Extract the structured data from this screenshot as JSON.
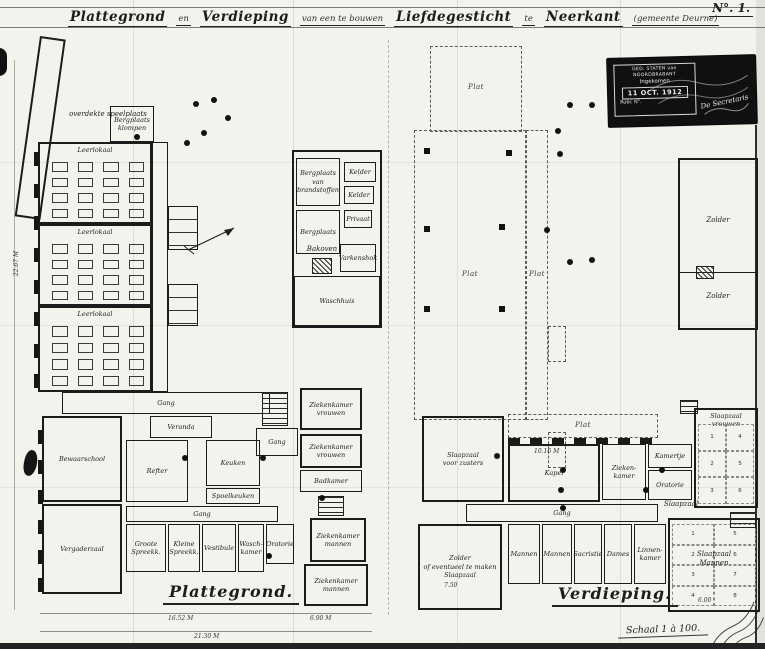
{
  "sheet": {
    "title_segments": [
      {
        "text": "Plattegrond"
      },
      {
        "text": "en"
      },
      {
        "text": "Verdieping"
      },
      {
        "text": "van een te bouwen"
      },
      {
        "text": "Liefdegesticht"
      },
      {
        "text": "te"
      },
      {
        "text": "Neerkant"
      },
      {
        "text": "(gemeente Deurne)"
      }
    ],
    "sheet_no": "N°. 1.",
    "stamp": {
      "agency": "GED. STATEN van NOORDBRABANT",
      "line_received": "Ingekomen",
      "date": "11 OCT. 1912",
      "rubric_label": "Rubr.        N°.",
      "secretary": "De Secretaris"
    },
    "scale_note": "Schaal 1 à 100.",
    "colors": {
      "paper": "#f3f2ec",
      "ink": "#1c1c1c",
      "stamp_bg": "#101010"
    }
  },
  "plan_left": {
    "caption": "Plattegrond.",
    "items": [
      {
        "type": "room",
        "name": "wing-overdekte-speelplaats",
        "label": "",
        "x": 40,
        "y": 36,
        "w": 26,
        "h": 182,
        "rot": 8,
        "thick": true
      },
      {
        "type": "text",
        "label": "overdekte speelplaats",
        "x": 56,
        "y": 110,
        "w": 104,
        "h": 12
      },
      {
        "type": "room",
        "label": "Bergplaats\nklompen",
        "x": 110,
        "y": 106,
        "w": 44,
        "h": 36
      },
      {
        "type": "room",
        "label": "Leerlokaal",
        "x": 38,
        "y": 142,
        "w": 114,
        "h": 82,
        "labelPos": "top",
        "thick": true
      },
      {
        "type": "desks",
        "x": 52,
        "y": 162,
        "w": 92,
        "h": 56,
        "cols": 4,
        "rows": 4
      },
      {
        "type": "room",
        "label": "Leerlokaal",
        "x": 38,
        "y": 224,
        "w": 114,
        "h": 82,
        "labelPos": "top",
        "thick": true
      },
      {
        "type": "desks",
        "x": 52,
        "y": 244,
        "w": 92,
        "h": 56,
        "cols": 4,
        "rows": 4
      },
      {
        "type": "room",
        "label": "Leerlokaal",
        "x": 38,
        "y": 306,
        "w": 114,
        "h": 86,
        "labelPos": "top",
        "thick": true
      },
      {
        "type": "desks",
        "x": 52,
        "y": 326,
        "w": 92,
        "h": 60,
        "cols": 4,
        "rows": 4
      },
      {
        "type": "room",
        "name": "gang-leerlokalen",
        "label": "",
        "x": 152,
        "y": 142,
        "w": 16,
        "h": 250
      },
      {
        "type": "privaat",
        "name": "privaten-a",
        "x": 168,
        "y": 206,
        "w": 30,
        "h": 44
      },
      {
        "type": "privaat",
        "name": "privaten-b",
        "x": 168,
        "y": 284,
        "w": 30,
        "h": 42
      },
      {
        "type": "room",
        "name": "utility-wing",
        "label": "",
        "x": 292,
        "y": 150,
        "w": 90,
        "h": 178,
        "thick": true
      },
      {
        "type": "room",
        "label": "Bergplaats\nvan\nbrandstoffen",
        "x": 296,
        "y": 158,
        "w": 44,
        "h": 48
      },
      {
        "type": "room",
        "label": "Kelder",
        "x": 344,
        "y": 162,
        "w": 32,
        "h": 20
      },
      {
        "type": "room",
        "label": "Kelder",
        "x": 344,
        "y": 186,
        "w": 30,
        "h": 18
      },
      {
        "type": "room",
        "label": "Bergplaats",
        "x": 296,
        "y": 210,
        "w": 44,
        "h": 44
      },
      {
        "type": "room",
        "label": "Privaat",
        "x": 344,
        "y": 210,
        "w": 28,
        "h": 18
      },
      {
        "type": "hatchbox",
        "name": "bakoven-hatch",
        "x": 312,
        "y": 258,
        "w": 20,
        "h": 16
      },
      {
        "type": "text",
        "label": "Bakoven",
        "x": 304,
        "y": 245,
        "w": 36,
        "h": 10
      },
      {
        "type": "room",
        "label": "Varkenshok",
        "x": 340,
        "y": 244,
        "w": 36,
        "h": 28
      },
      {
        "type": "room",
        "label": "Waschhuis",
        "x": 294,
        "y": 276,
        "w": 86,
        "h": 50
      },
      {
        "type": "room",
        "label": "Gang",
        "x": 62,
        "y": 392,
        "w": 208,
        "h": 22
      },
      {
        "type": "room",
        "label": "Veranda",
        "x": 150,
        "y": 416,
        "w": 62,
        "h": 22
      },
      {
        "type": "room",
        "label": "Bewaarschool",
        "x": 42,
        "y": 416,
        "w": 80,
        "h": 86,
        "thick": true
      },
      {
        "type": "room",
        "label": "Refter",
        "x": 126,
        "y": 440,
        "w": 62,
        "h": 62
      },
      {
        "type": "room",
        "label": "Keuken",
        "x": 206,
        "y": 440,
        "w": 54,
        "h": 46
      },
      {
        "type": "room",
        "label": "Spoelkeuken",
        "x": 206,
        "y": 488,
        "w": 54,
        "h": 16
      },
      {
        "type": "room",
        "name": "gang-bottom",
        "label": "Gang",
        "x": 126,
        "y": 506,
        "w": 152,
        "h": 16
      },
      {
        "type": "room",
        "label": "Vergaderzaal",
        "x": 42,
        "y": 504,
        "w": 80,
        "h": 90,
        "thick": true
      },
      {
        "type": "room",
        "label": "Groote\nSpreekk.",
        "x": 126,
        "y": 524,
        "w": 40,
        "h": 48
      },
      {
        "type": "room",
        "label": "Kleine\nSpreekk.",
        "x": 168,
        "y": 524,
        "w": 32,
        "h": 48
      },
      {
        "type": "room",
        "label": "Vestibule",
        "x": 202,
        "y": 524,
        "w": 34,
        "h": 48
      },
      {
        "type": "room",
        "label": "Wasch-\nkamer",
        "x": 238,
        "y": 524,
        "w": 26,
        "h": 48
      },
      {
        "type": "room",
        "label": "Oratorie",
        "x": 266,
        "y": 524,
        "w": 28,
        "h": 40
      },
      {
        "type": "stairs",
        "name": "trap-midden",
        "x": 262,
        "y": 392,
        "w": 26,
        "h": 34
      },
      {
        "type": "room",
        "label": "Gang",
        "x": 256,
        "y": 428,
        "w": 42,
        "h": 28
      },
      {
        "type": "room",
        "label": "Ziekenkamer\nvrouwen",
        "x": 300,
        "y": 388,
        "w": 62,
        "h": 42,
        "thick": true
      },
      {
        "type": "room",
        "label": "Ziekenkamer\nvrouwen",
        "x": 300,
        "y": 434,
        "w": 62,
        "h": 34,
        "thick": true
      },
      {
        "type": "room",
        "label": "Badkamer",
        "x": 300,
        "y": 470,
        "w": 62,
        "h": 22
      },
      {
        "type": "stairs",
        "name": "trap-rechts",
        "x": 318,
        "y": 496,
        "w": 26,
        "h": 20
      },
      {
        "type": "room",
        "label": "Ziekenkamer\nmannen",
        "x": 310,
        "y": 518,
        "w": 56,
        "h": 44,
        "thick": true
      },
      {
        "type": "room",
        "label": "Ziekenkamer\nmannen",
        "x": 304,
        "y": 564,
        "w": 64,
        "h": 42,
        "thick": true
      },
      {
        "type": "pier",
        "x": 34,
        "y": 152,
        "w": 5,
        "h": 14
      },
      {
        "type": "pier",
        "x": 34,
        "y": 184,
        "w": 5,
        "h": 14
      },
      {
        "type": "pier",
        "x": 34,
        "y": 216,
        "w": 5,
        "h": 14
      },
      {
        "type": "pier",
        "x": 34,
        "y": 248,
        "w": 5,
        "h": 14
      },
      {
        "type": "pier",
        "x": 34,
        "y": 280,
        "w": 5,
        "h": 14
      },
      {
        "type": "pier",
        "x": 34,
        "y": 312,
        "w": 5,
        "h": 14
      },
      {
        "type": "pier",
        "x": 34,
        "y": 344,
        "w": 5,
        "h": 14
      },
      {
        "type": "pier",
        "x": 34,
        "y": 374,
        "w": 5,
        "h": 14
      },
      {
        "type": "pier",
        "x": 38,
        "y": 430,
        "w": 5,
        "h": 14
      },
      {
        "type": "pier",
        "x": 38,
        "y": 460,
        "w": 5,
        "h": 14
      },
      {
        "type": "pier",
        "x": 38,
        "y": 490,
        "w": 5,
        "h": 14
      },
      {
        "type": "pier",
        "x": 38,
        "y": 520,
        "w": 5,
        "h": 14
      },
      {
        "type": "pier",
        "x": 38,
        "y": 550,
        "w": 5,
        "h": 14
      },
      {
        "type": "pier",
        "x": 38,
        "y": 578,
        "w": 5,
        "h": 14
      }
    ]
  },
  "plan_right": {
    "caption": "Verdieping.",
    "items": [
      {
        "type": "dashed",
        "label": "Plat",
        "x": 430,
        "y": 46,
        "w": 92,
        "h": 86,
        "labelPos": "bottom"
      },
      {
        "type": "dashed",
        "label": "Plat",
        "x": 414,
        "y": 130,
        "w": 112,
        "h": 290
      },
      {
        "type": "dashed",
        "label": "Plat",
        "x": 526,
        "y": 130,
        "w": 22,
        "h": 290
      },
      {
        "type": "dashed",
        "label": "",
        "x": 548,
        "y": 326,
        "w": 18,
        "h": 36
      },
      {
        "type": "dashed",
        "label": "",
        "x": 548,
        "y": 432,
        "w": 18,
        "h": 36
      },
      {
        "type": "room",
        "label": "Slaapzaal\nvoor zusters",
        "x": 422,
        "y": 416,
        "w": 82,
        "h": 86,
        "thick": true
      },
      {
        "type": "dashed",
        "label": "Plat",
        "x": 508,
        "y": 414,
        "w": 150,
        "h": 24
      },
      {
        "type": "wallrow",
        "name": "borstwering",
        "x": 508,
        "y": 438,
        "w": 150,
        "h": 6
      },
      {
        "type": "room",
        "label": "Kapel",
        "x": 508,
        "y": 444,
        "w": 92,
        "h": 58,
        "thick": true
      },
      {
        "type": "room",
        "label": "Zieken-\nkamer",
        "x": 602,
        "y": 444,
        "w": 44,
        "h": 56
      },
      {
        "type": "room",
        "label": "Kamertje",
        "x": 648,
        "y": 444,
        "w": 44,
        "h": 24
      },
      {
        "type": "room",
        "label": "Oratorie",
        "x": 648,
        "y": 470,
        "w": 44,
        "h": 30
      },
      {
        "type": "stairs",
        "name": "trap-boven",
        "x": 680,
        "y": 400,
        "w": 18,
        "h": 14
      },
      {
        "type": "room",
        "label": "Slaapzaal\nvrouwen",
        "x": 694,
        "y": 408,
        "w": 64,
        "h": 100,
        "thick": true,
        "labelPos": "top"
      },
      {
        "type": "cells",
        "x": 698,
        "y": 424,
        "w": 56,
        "h": 80,
        "cols": 2,
        "rows": 3,
        "numbers": [
          "1",
          "4",
          "2",
          "5",
          "3",
          "6"
        ]
      },
      {
        "type": "room",
        "label": "Gang",
        "x": 466,
        "y": 504,
        "w": 192,
        "h": 18
      },
      {
        "type": "room",
        "label": "Zolder\nof eventueel te maken\nSlaapzaal",
        "x": 418,
        "y": 524,
        "w": 84,
        "h": 86,
        "thick": true
      },
      {
        "type": "room",
        "label": "Mannen",
        "x": 508,
        "y": 524,
        "w": 32,
        "h": 60
      },
      {
        "type": "room",
        "label": "Mannen",
        "x": 542,
        "y": 524,
        "w": 30,
        "h": 60
      },
      {
        "type": "room",
        "label": "Sacristie",
        "x": 574,
        "y": 524,
        "w": 28,
        "h": 60
      },
      {
        "type": "room",
        "label": "Dames",
        "x": 604,
        "y": 524,
        "w": 28,
        "h": 60
      },
      {
        "type": "room",
        "label": "Linnen-\nkamer",
        "x": 634,
        "y": 524,
        "w": 32,
        "h": 60
      },
      {
        "type": "text",
        "label": "Slaapzaal",
        "x": 656,
        "y": 500,
        "w": 50,
        "h": 10
      },
      {
        "type": "room",
        "name": "slaapzaal-mannen-blok",
        "label": "",
        "x": 668,
        "y": 518,
        "w": 92,
        "h": 94,
        "thick": true
      },
      {
        "type": "cells",
        "x": 672,
        "y": 524,
        "w": 84,
        "h": 82,
        "cols": 2,
        "rows": 4,
        "numbers": [
          "1",
          "5",
          "2",
          "6",
          "3",
          "7",
          "4",
          "8"
        ]
      },
      {
        "type": "text",
        "label": "Slaapzaal\nMannen",
        "x": 676,
        "y": 550,
        "w": 76,
        "h": 20
      },
      {
        "type": "stairs",
        "name": "trap-rechtsonder",
        "x": 730,
        "y": 512,
        "w": 26,
        "h": 16
      },
      {
        "type": "room",
        "name": "bijgebouw-zolder",
        "label": "",
        "x": 678,
        "y": 158,
        "w": 80,
        "h": 172,
        "thick": true
      },
      {
        "type": "hline",
        "name": "zolder-scheiding",
        "x": 680,
        "y": 272,
        "w": 76,
        "h": 2
      },
      {
        "type": "text",
        "label": "Zolder",
        "x": 698,
        "y": 216,
        "w": 40,
        "h": 10
      },
      {
        "type": "text",
        "label": "Zolder",
        "x": 698,
        "y": 292,
        "w": 40,
        "h": 10
      },
      {
        "type": "hatchbox",
        "name": "zolder-luik",
        "x": 696,
        "y": 266,
        "w": 18,
        "h": 13
      }
    ]
  },
  "marks": {
    "dots": [
      [
        196,
        104
      ],
      [
        214,
        100
      ],
      [
        228,
        118
      ],
      [
        204,
        133
      ],
      [
        187,
        143
      ],
      [
        137,
        137
      ],
      [
        570,
        105
      ],
      [
        592,
        105
      ],
      [
        558,
        131
      ],
      [
        560,
        154
      ],
      [
        570,
        262
      ],
      [
        592,
        260
      ],
      [
        547,
        230
      ],
      [
        563,
        470
      ],
      [
        561,
        490
      ],
      [
        497,
        456
      ],
      [
        185,
        458
      ],
      [
        263,
        458
      ],
      [
        322,
        498
      ],
      [
        269,
        556
      ],
      [
        646,
        490
      ],
      [
        662,
        470
      ],
      [
        563,
        508
      ]
    ],
    "chimneys": [
      [
        424,
        148
      ],
      [
        424,
        226
      ],
      [
        499,
        224
      ],
      [
        424,
        306
      ],
      [
        499,
        306
      ],
      [
        506,
        150
      ]
    ],
    "dimensions": [
      {
        "text": "16.52 M",
        "x": 168,
        "y": 615
      },
      {
        "text": "6.90 M",
        "x": 310,
        "y": 615
      },
      {
        "text": "21.30 M",
        "x": 194,
        "y": 633
      },
      {
        "text": "10.16 M",
        "x": 534,
        "y": 448
      },
      {
        "text": "7.50",
        "x": 444,
        "y": 582
      },
      {
        "text": "6.00",
        "x": 698,
        "y": 597
      },
      {
        "text": "22.67 M",
        "x": 4,
        "y": 260,
        "rot": -90
      }
    ]
  }
}
